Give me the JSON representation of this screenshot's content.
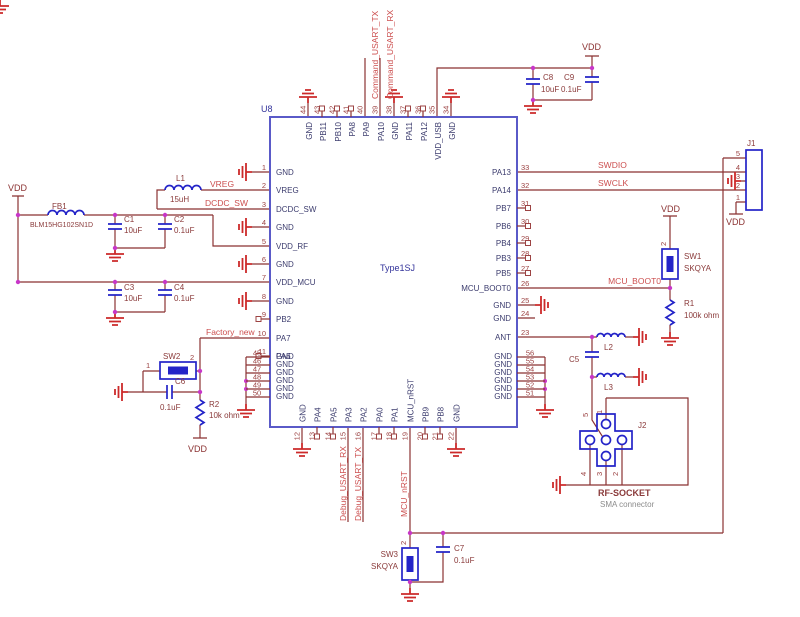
{
  "schematic": {
    "ic": {
      "ref": "U8",
      "part": "Type1SJ",
      "pins_top": [
        {
          "n": "44",
          "name": "GND"
        },
        {
          "n": "43",
          "name": "PB11"
        },
        {
          "n": "42",
          "name": "PB10"
        },
        {
          "n": "41",
          "name": "PA8"
        },
        {
          "n": "40",
          "name": "PA9"
        },
        {
          "n": "39",
          "name": "PA10"
        },
        {
          "n": "38",
          "name": "GND"
        },
        {
          "n": "37",
          "name": "PA11"
        },
        {
          "n": "36",
          "name": "PA12"
        },
        {
          "n": "35",
          "name": "VDD_USB"
        },
        {
          "n": "34",
          "name": "GND"
        }
      ],
      "pins_left": [
        {
          "n": "1",
          "name": "GND"
        },
        {
          "n": "2",
          "name": "VREG"
        },
        {
          "n": "3",
          "name": "DCDC_SW"
        },
        {
          "n": "4",
          "name": "GND"
        },
        {
          "n": "5",
          "name": "VDD_RF"
        },
        {
          "n": "6",
          "name": "GND"
        },
        {
          "n": "7",
          "name": "VDD_MCU"
        },
        {
          "n": "8",
          "name": "GND"
        },
        {
          "n": "9",
          "name": "PB2"
        },
        {
          "n": "10",
          "name": "PA7"
        },
        {
          "n": "11",
          "name": "PA6"
        }
      ],
      "pins_right": [
        {
          "n": "33",
          "name": "PA13"
        },
        {
          "n": "32",
          "name": "PA14"
        },
        {
          "n": "31",
          "name": "PB7"
        },
        {
          "n": "30",
          "name": "PB6"
        },
        {
          "n": "29",
          "name": "PB4"
        },
        {
          "n": "28",
          "name": "PB3"
        },
        {
          "n": "27",
          "name": "PB5"
        },
        {
          "n": "26",
          "name": "MCU_BOOT0"
        },
        {
          "n": "25",
          "name": "GND"
        },
        {
          "n": "24",
          "name": "GND"
        },
        {
          "n": "23",
          "name": "ANT"
        }
      ],
      "pins_bottom": [
        {
          "n": "12",
          "name": "GND"
        },
        {
          "n": "13",
          "name": "PA4"
        },
        {
          "n": "14",
          "name": "PA5"
        },
        {
          "n": "15",
          "name": "PA3"
        },
        {
          "n": "16",
          "name": "PA2"
        },
        {
          "n": "17",
          "name": "PA0"
        },
        {
          "n": "18",
          "name": "PA1"
        },
        {
          "n": "19",
          "name": "MCU_nRST"
        },
        {
          "n": "20",
          "name": "PB9"
        },
        {
          "n": "21",
          "name": "PB8"
        },
        {
          "n": "22",
          "name": "GND"
        }
      ],
      "pins_gnd_block_left": [
        {
          "n": "45",
          "name": "GND"
        },
        {
          "n": "46",
          "name": "GND"
        },
        {
          "n": "47",
          "name": "GND"
        },
        {
          "n": "48",
          "name": "GND"
        },
        {
          "n": "49",
          "name": "GND"
        },
        {
          "n": "50",
          "name": "GND"
        }
      ],
      "pins_gnd_block_right": [
        {
          "n": "56",
          "name": "GND"
        },
        {
          "n": "55",
          "name": "GND"
        },
        {
          "n": "54",
          "name": "GND"
        },
        {
          "n": "53",
          "name": "GND"
        },
        {
          "n": "52",
          "name": "GND"
        },
        {
          "n": "51",
          "name": "GND"
        }
      ]
    },
    "power": {
      "vdd": "VDD"
    },
    "nets": {
      "vreg": "VREG",
      "dcdc_sw": "DCDC_SW",
      "factory_new": "Factory_new",
      "command_tx": "Command_USART_TX",
      "command_rx": "Command_USART_RX",
      "swdio": "SWDIO",
      "swclk": "SWCLK",
      "mcu_boot0": "MCU_BOOT0",
      "debug_rx": "Debug_USART_RX",
      "debug_tx": "Debug_USART_TX",
      "mcu_nrst": "MCU_nRST"
    },
    "components": {
      "fb1": {
        "ref": "FB1",
        "value": "BLM15HG102SN1D"
      },
      "l1": {
        "ref": "L1",
        "value": "15uH"
      },
      "l2": {
        "ref": "L2"
      },
      "l3": {
        "ref": "L3"
      },
      "c1": {
        "ref": "C1",
        "value": "10uF"
      },
      "c2": {
        "ref": "C2",
        "value": "0.1uF"
      },
      "c3": {
        "ref": "C3",
        "value": "10uF"
      },
      "c4": {
        "ref": "C4",
        "value": "0.1uF"
      },
      "c5": {
        "ref": "C5"
      },
      "c6": {
        "ref": "C6",
        "value": "0.1uF"
      },
      "c7": {
        "ref": "C7",
        "value": "0.1uF"
      },
      "c8": {
        "ref": "C8",
        "value": "10uF"
      },
      "c9": {
        "ref": "C9",
        "value": "0.1uF"
      },
      "r1": {
        "ref": "R1",
        "value": "100k ohm"
      },
      "r2": {
        "ref": "R2",
        "value": "10k ohm"
      },
      "sw1": {
        "ref": "SW1",
        "value": "SKQYA"
      },
      "sw2": {
        "ref": "SW2"
      },
      "sw3": {
        "ref": "SW3",
        "value": "SKQYA"
      }
    },
    "connectors": {
      "j1": {
        "ref": "J1",
        "pins": [
          "5",
          "4",
          "3",
          "2",
          "1"
        ]
      },
      "j2": {
        "ref": "J2",
        "name": "RF-SOCKET",
        "subtitle": "SMA connector",
        "pins": {
          "p5": "5",
          "p1": "1",
          "p4": "4",
          "p3": "3",
          "p2": "2"
        }
      }
    },
    "switch_pins": {
      "sw1_p2": "2",
      "sw2_p1": "1",
      "sw2_p2": "2",
      "sw3_p2": "2"
    },
    "colors": {
      "wire": "#8b3232",
      "net_label": "#cc4f4f",
      "component": "#2424c8",
      "ic_outline": "#5a5ac8",
      "ground": "#cc2a2a",
      "junction": "#c837c8",
      "pin_number": "#9c4343",
      "pin_name": "#3c3c6e",
      "ref_label": "#8a3a3a",
      "note": "#8c8c8c",
      "navy": "#34349b",
      "background": "#ffffff"
    }
  }
}
